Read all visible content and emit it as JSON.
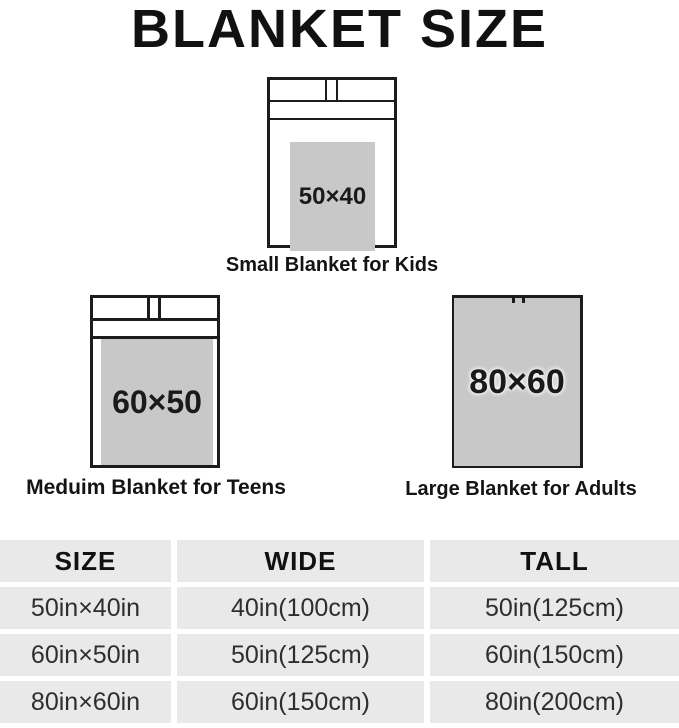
{
  "title": "BLANKET SIZE",
  "diagrams": {
    "small": {
      "blanket_label": "50×40",
      "caption": "Small Blanket for Kids"
    },
    "medium": {
      "blanket_label": "60×50",
      "caption": "Meduim Blanket for Teens"
    },
    "large": {
      "blanket_label": "80×60",
      "caption": "Large Blanket for Adults"
    }
  },
  "size_table": {
    "headers": [
      "SIZE",
      "WIDE",
      "TALL"
    ],
    "rows": [
      [
        "50in×40in",
        "40in(100cm)",
        "50in(125cm)"
      ],
      [
        "60in×50in",
        "50in(125cm)",
        "60in(150cm)"
      ],
      [
        "80in×60in",
        "60in(150cm)",
        "80in(200cm)"
      ]
    ]
  },
  "colors": {
    "blanket_fill": "#c8c8c8",
    "bed_outline": "#1c1c1c",
    "table_cell_bg": "#e9e9e9",
    "title_text": "#111111"
  }
}
